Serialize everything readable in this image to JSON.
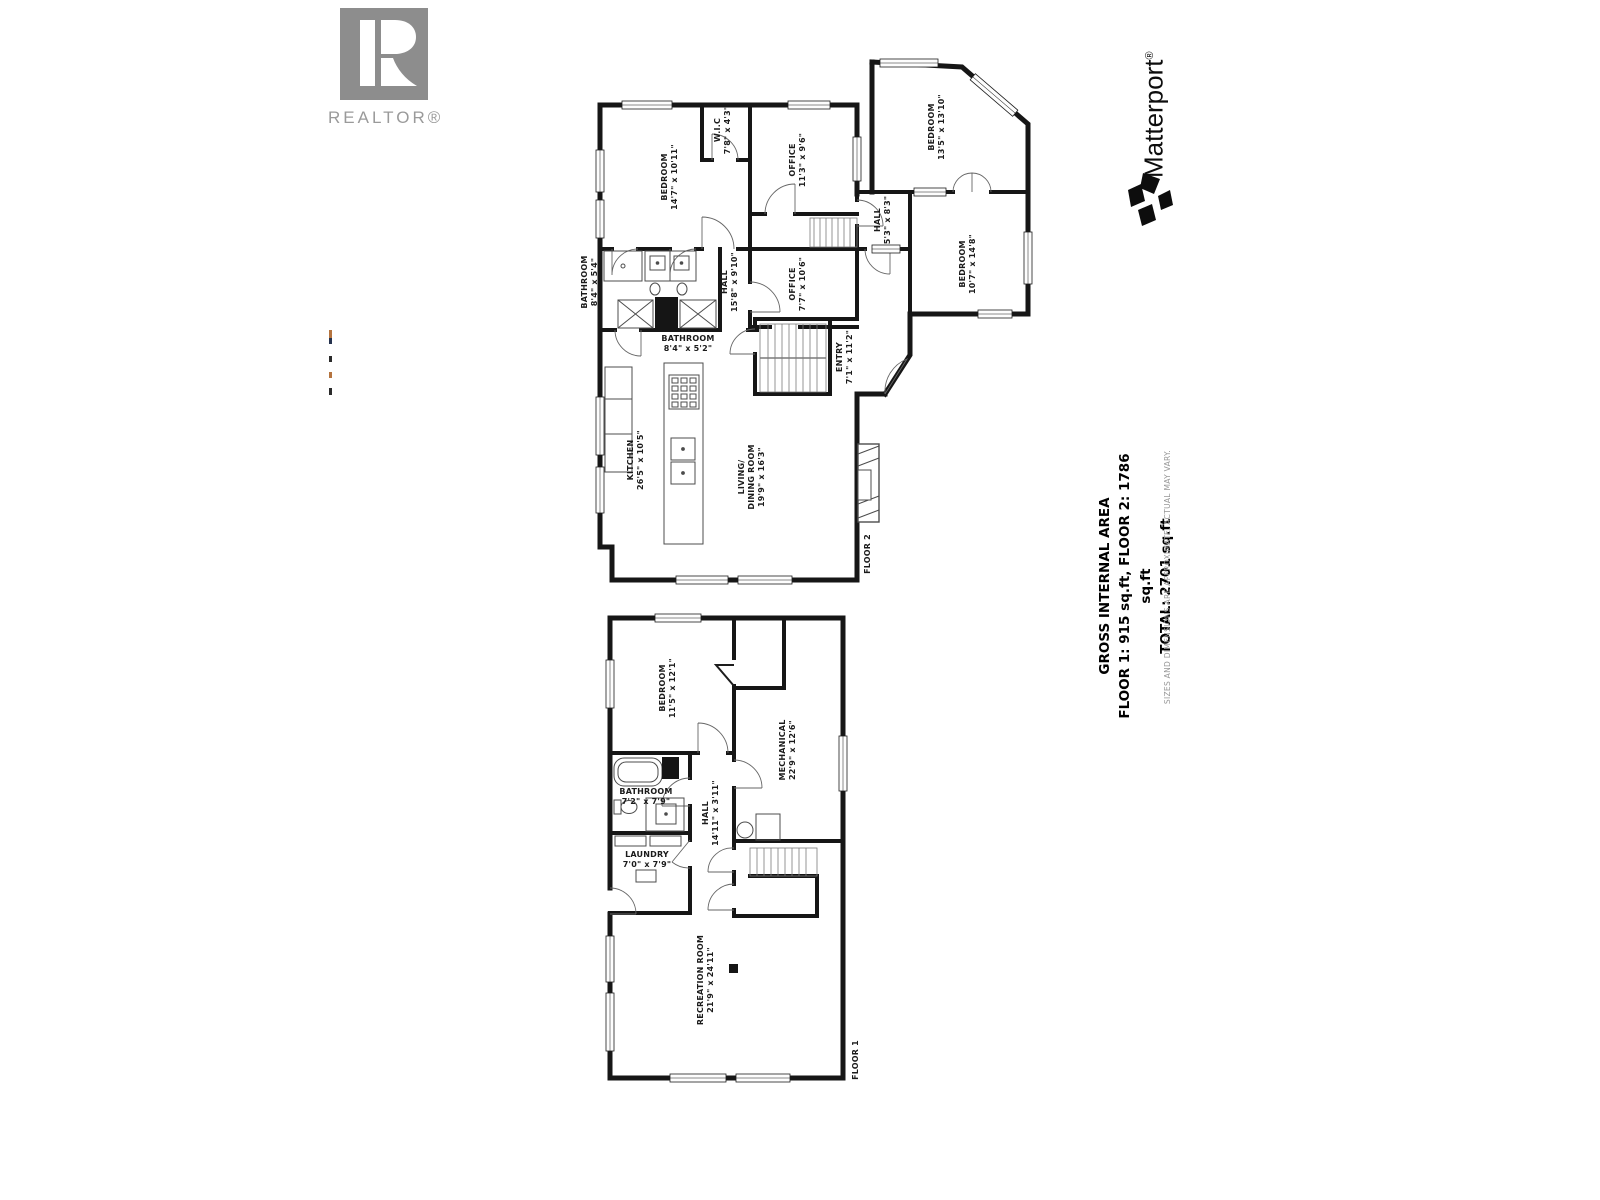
{
  "branding": {
    "realtor": {
      "caption": "REALTOR®"
    },
    "matterport": {
      "wordmark": "Matterport",
      "reg": "®"
    }
  },
  "summary": {
    "title": "GROSS INTERNAL AREA",
    "floors_line": "FLOOR 1: 915 sq.ft, FLOOR 2: 1786 sq.ft",
    "total_line": "TOTAL: 2701 sq.ft",
    "disclaimer": "SIZES AND DIMENSIONS ARE APPROXIMATE, ACTUAL MAY VARY."
  },
  "floor2": {
    "label": "FLOOR 2",
    "rooms": [
      {
        "name": "BEDROOM",
        "dims": "14'7\" x 10'11\""
      },
      {
        "name": "W.I.C",
        "dims": "7'8\" x 4'3\""
      },
      {
        "name": "OFFICE",
        "dims": "11'3\" x 9'6\""
      },
      {
        "name": "BEDROOM",
        "dims": "13'5\" x 13'10\""
      },
      {
        "name": "HALL",
        "dims": "5'3\" x 8'3\""
      },
      {
        "name": "BEDROOM",
        "dims": "10'7\" x 14'8\""
      },
      {
        "name": "BATHROOM",
        "dims": "8'4\" x 5'4\""
      },
      {
        "name": "HALL",
        "dims": "15'8\" x 9'10\""
      },
      {
        "name": "OFFICE",
        "dims": "7'7\" x 10'6\""
      },
      {
        "name": "BATHROOM",
        "dims": "8'4\" x 5'2\""
      },
      {
        "name": "ENTRY",
        "dims": "7'1\" x 11'2\""
      },
      {
        "name": "KITCHEN",
        "dims": "26'5\" x 10'5\""
      },
      {
        "name": "LIVING/",
        "name2": "DINING ROOM",
        "dims": "19'9\" x 16'3\""
      }
    ]
  },
  "floor1": {
    "label": "FLOOR 1",
    "rooms": [
      {
        "name": "BEDROOM",
        "dims": "11'5\" x 12'1\""
      },
      {
        "name": "MECHANICAL",
        "dims": "22'9\" x 12'6\""
      },
      {
        "name": "BATHROOM",
        "dims": "7'2\" x 7'9\""
      },
      {
        "name": "HALL",
        "dims": "14'11\" x 3'11\""
      },
      {
        "name": "LAUNDRY",
        "dims": "7'0\" x 7'9\""
      },
      {
        "name": "RECREATION ROOM",
        "dims": "21'9\" x 24'11\""
      }
    ]
  }
}
